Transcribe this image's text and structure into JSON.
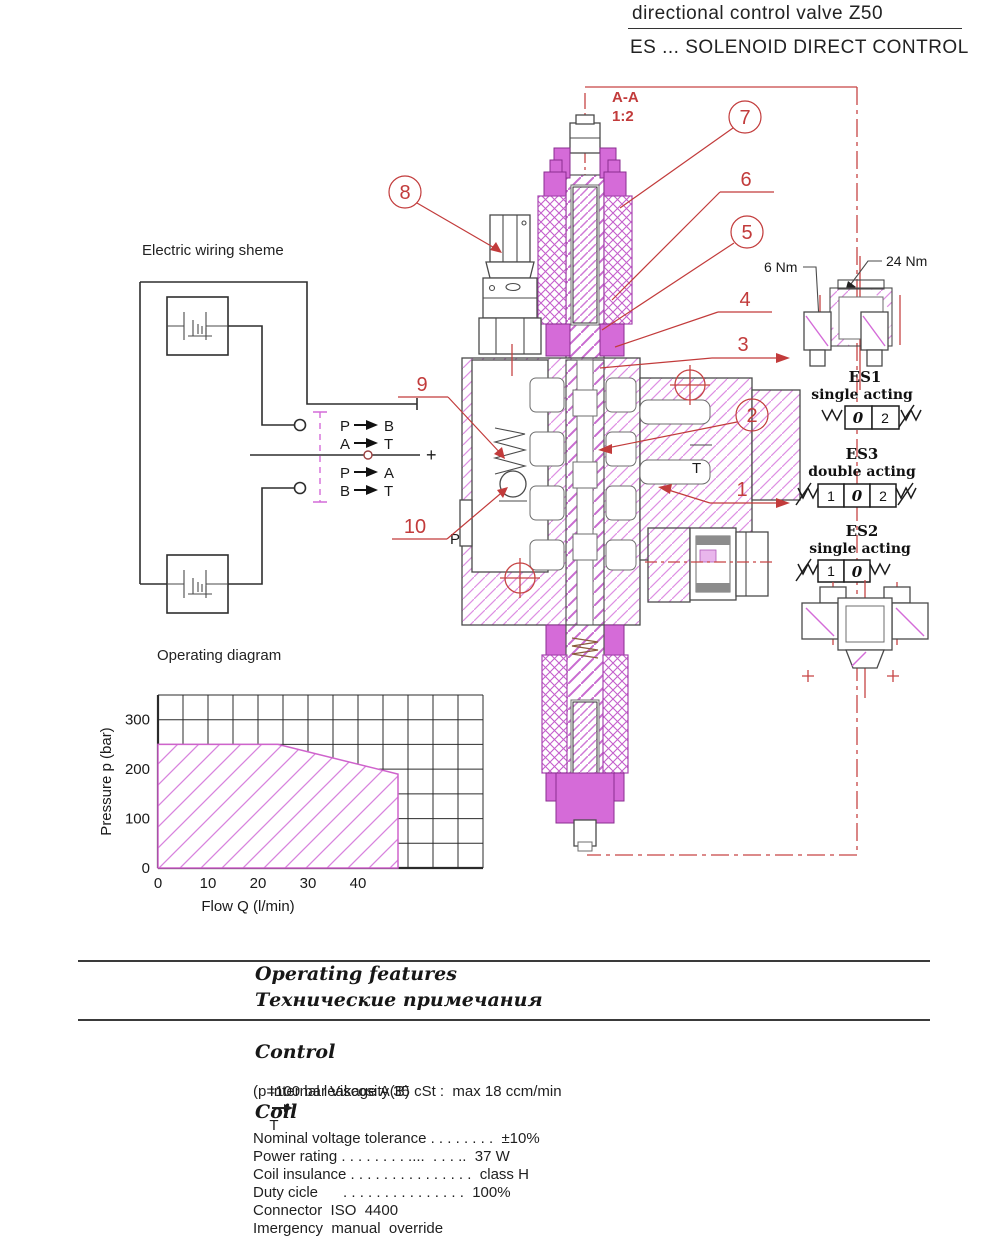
{
  "header": {
    "title": "directional control valve Z50",
    "subtitle": "ES ... SOLENOID DIRECT CONTROL"
  },
  "section_view": {
    "label": "A-A",
    "scale": "1:2"
  },
  "wiring": {
    "title": "Electric wiring sheme",
    "plus_sign": "+",
    "mappings": [
      {
        "from": "P",
        "to": "B"
      },
      {
        "from": "A",
        "to": "T"
      },
      {
        "from": "P",
        "to": "A"
      },
      {
        "from": "B",
        "to": "T"
      }
    ]
  },
  "callouts": {
    "c1": "1",
    "c2": "2",
    "c3": "3",
    "c4": "4",
    "c5": "5",
    "c6": "6",
    "c7": "7",
    "c8": "8",
    "c9": "9",
    "c10": "10"
  },
  "ports": {
    "p": "P",
    "t": "T"
  },
  "torque": {
    "small": "6 Nm",
    "large": "24 Nm"
  },
  "variants": [
    {
      "code": "ES1",
      "type": "single acting",
      "cells": [
        "0",
        "2"
      ]
    },
    {
      "code": "ES3",
      "type": "double acting",
      "cells": [
        "1",
        "0",
        "2"
      ]
    },
    {
      "code": "ES2",
      "type": "single acting",
      "cells": [
        "1",
        "0"
      ]
    }
  ],
  "chart_data": {
    "type": "area",
    "title": "Operating diagram",
    "xlabel": "Flow Q (l/min)",
    "ylabel": "Pressure p (bar)",
    "xlim": [
      0,
      65
    ],
    "ylim": [
      0,
      350
    ],
    "x_grid_step": 5,
    "y_grid_step": 50,
    "xticks": [
      0,
      10,
      20,
      30,
      40
    ],
    "yticks": [
      0,
      100,
      200,
      300
    ],
    "grid": true,
    "area_color": "#cf63cc",
    "series": [
      {
        "name": "permissible operating range",
        "points": [
          [
            0,
            250
          ],
          [
            24,
            250
          ],
          [
            48,
            190
          ],
          [
            48,
            0
          ]
        ]
      }
    ]
  },
  "features": {
    "heading_en": "Operating features",
    "heading_ru": "Технические примечания",
    "control": {
      "heading": "Control",
      "leakage_pre": "Internal leakage A(B)",
      "leakage_post": "T",
      "condition": "(p=100 bar Viscosity 35 cSt :  max 18 ccm/min"
    },
    "coil": {
      "heading": "Coil",
      "specs": [
        "Nominal voltage tolerance . . . . . . . .  ±10%",
        "Power rating . . . . . . . . ....  . . . ..  37 W",
        "Coil insulance . . . . . . . . . . . . . . .  class H",
        "Duty cicle      . . . . . . . . . . . . . . .  100%",
        "Connector  ISO  4400",
        "Imergency  manual  override"
      ]
    }
  }
}
